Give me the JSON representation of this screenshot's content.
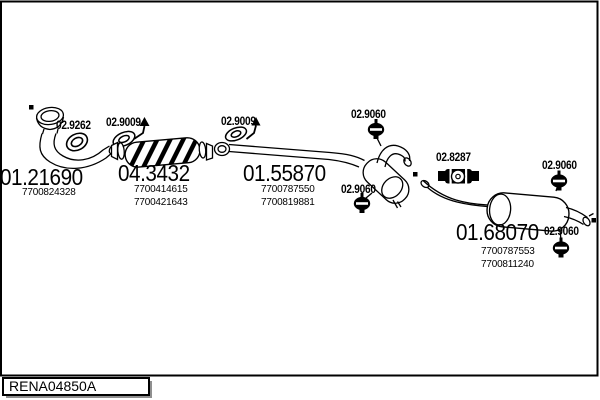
{
  "window": {
    "tab_label": "RENA04850A"
  },
  "diagram": {
    "type": "exhaust-system-parts-diagram",
    "colors": {
      "line": "#000000",
      "background": "#ffffff"
    },
    "sections": [
      {
        "code": "01.21690",
        "oem_refs": [
          "7700824328"
        ]
      },
      {
        "code": "04.3432",
        "oem_refs": [
          "7700414615",
          "7700421643"
        ]
      },
      {
        "code": "01.55870",
        "oem_refs": [
          "7700787550",
          "7700819881"
        ]
      },
      {
        "code": "01.68070",
        "oem_refs": [
          "7700787553",
          "7700811240"
        ]
      }
    ],
    "fittings": [
      {
        "code": "02.9262",
        "kind": "clamp-ring"
      },
      {
        "code": "02.9009",
        "kind": "gasket"
      },
      {
        "code": "02.9009",
        "kind": "gasket"
      },
      {
        "code": "02.9060",
        "kind": "rubber-hanger"
      },
      {
        "code": "02.9060",
        "kind": "rubber-hanger"
      },
      {
        "code": "02.8287",
        "kind": "sleeve-clamp"
      },
      {
        "code": "02.9060",
        "kind": "rubber-hanger"
      },
      {
        "code": "02.9060",
        "kind": "rubber-hanger"
      }
    ]
  }
}
